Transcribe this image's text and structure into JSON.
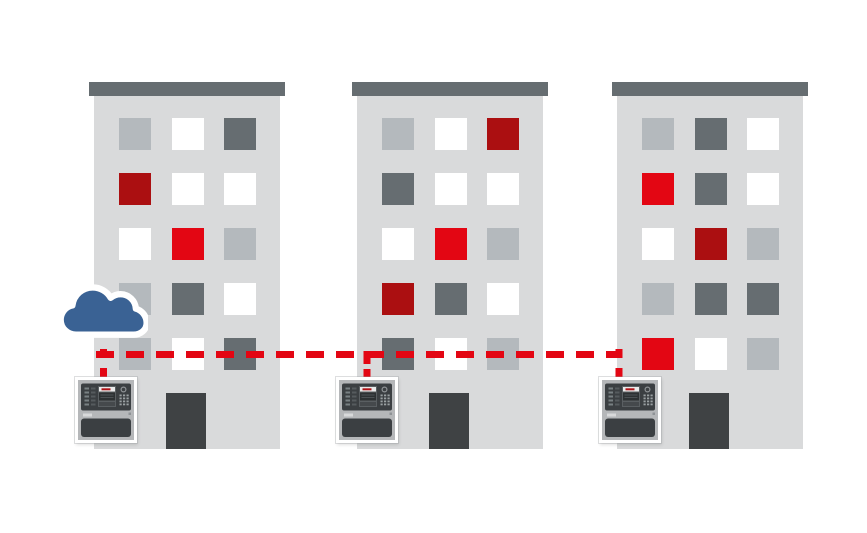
{
  "colors": {
    "ui": {
      "background": "#ffffff",
      "building-body": "#d9dadb",
      "roof": "#666d71",
      "door": "#3f4244",
      "cloud": "#3a6294",
      "line": "#e30613",
      "panel-frame": "#ffffff",
      "panel-body": "#b5b7b9",
      "panel-dark": "#3b3f42",
      "panel-logo-red": "#b01116"
    },
    "window": {
      "white": "#ffffff",
      "light": "#b4b9bd",
      "dark": "#666d71",
      "red": "#e30613",
      "darkred": "#ab0f11"
    }
  },
  "cloud": {
    "icon": "cloud-icon"
  },
  "connection": {
    "style": "dashed",
    "color": "#e30613"
  },
  "buildings": [
    {
      "name": "building-1",
      "windows": [
        [
          "light",
          "white",
          "dark"
        ],
        [
          "darkred",
          "white",
          "white"
        ],
        [
          "white",
          "red",
          "light"
        ],
        [
          "light",
          "dark",
          "white"
        ],
        [
          "light",
          "white",
          "dark"
        ]
      ]
    },
    {
      "name": "building-2",
      "windows": [
        [
          "light",
          "white",
          "darkred"
        ],
        [
          "dark",
          "white",
          "white"
        ],
        [
          "white",
          "red",
          "light"
        ],
        [
          "darkred",
          "dark",
          "white"
        ],
        [
          "dark",
          "white",
          "light"
        ]
      ]
    },
    {
      "name": "building-3",
      "windows": [
        [
          "light",
          "dark",
          "white"
        ],
        [
          "red",
          "dark",
          "white"
        ],
        [
          "white",
          "darkred",
          "light"
        ],
        [
          "light",
          "dark",
          "dark"
        ],
        [
          "red",
          "white",
          "light"
        ]
      ]
    }
  ],
  "panels": [
    {
      "name": "fire-alarm-panel-1"
    },
    {
      "name": "fire-alarm-panel-2"
    },
    {
      "name": "fire-alarm-panel-3"
    }
  ]
}
